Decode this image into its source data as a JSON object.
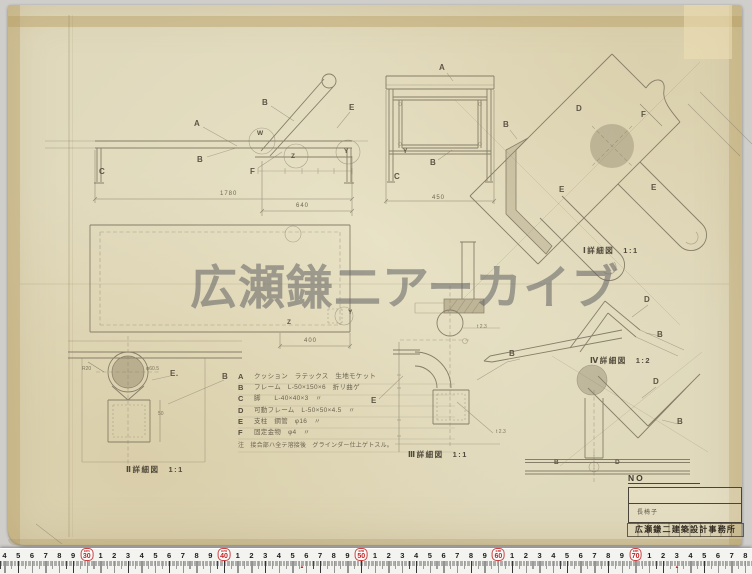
{
  "scan": {
    "watermark": "広瀬鎌二アーカイブ"
  },
  "annotations": [
    {
      "t": "A",
      "x": 194,
      "y": 119,
      "cls": "lbl"
    },
    {
      "t": "B",
      "x": 262,
      "y": 98,
      "cls": "lbl"
    },
    {
      "t": "E",
      "x": 349,
      "y": 103,
      "cls": "lbl"
    },
    {
      "t": "W",
      "x": 257,
      "y": 130,
      "cls": "sm"
    },
    {
      "t": "Z",
      "x": 291,
      "y": 153,
      "cls": "sm"
    },
    {
      "t": "Y",
      "x": 344,
      "y": 148,
      "cls": "sm"
    },
    {
      "t": "B",
      "x": 197,
      "y": 155,
      "cls": "lbl"
    },
    {
      "t": "F",
      "x": 250,
      "y": 167,
      "cls": "lbl"
    },
    {
      "t": "C",
      "x": 99,
      "y": 167,
      "cls": "lbl"
    },
    {
      "t": "1780",
      "x": 220,
      "y": 191,
      "cls": "dim"
    },
    {
      "t": "640",
      "x": 296,
      "y": 203,
      "cls": "dim"
    },
    {
      "t": "A",
      "x": 439,
      "y": 63,
      "cls": "lbl"
    },
    {
      "t": "Y",
      "x": 403,
      "y": 148,
      "cls": "sm"
    },
    {
      "t": "B",
      "x": 430,
      "y": 158,
      "cls": "lbl"
    },
    {
      "t": "C",
      "x": 394,
      "y": 172,
      "cls": "lbl"
    },
    {
      "t": "450",
      "x": 432,
      "y": 195,
      "cls": "dim"
    },
    {
      "t": "Y",
      "x": 348,
      "y": 309,
      "cls": "sm"
    },
    {
      "t": "Z",
      "x": 287,
      "y": 319,
      "cls": "sm"
    },
    {
      "t": "400",
      "x": 304,
      "y": 338,
      "cls": "dim"
    },
    {
      "t": "B",
      "x": 503,
      "y": 120,
      "cls": "lbl"
    },
    {
      "t": "D",
      "x": 576,
      "y": 104,
      "cls": "lbl"
    },
    {
      "t": "F",
      "x": 641,
      "y": 110,
      "cls": "lbl"
    },
    {
      "t": "E",
      "x": 559,
      "y": 185,
      "cls": "lbl"
    },
    {
      "t": "E",
      "x": 651,
      "y": 183,
      "cls": "lbl"
    },
    {
      "t": "Ⅰ詳細図　1:1",
      "x": 583,
      "y": 245,
      "cls": "cap"
    },
    {
      "t": "E.",
      "x": 170,
      "y": 369,
      "cls": "lbl"
    },
    {
      "t": "B",
      "x": 222,
      "y": 372,
      "cls": "lbl"
    },
    {
      "t": "Ⅱ詳細図　1:1",
      "x": 126,
      "y": 464,
      "cls": "cap"
    },
    {
      "t": "R20",
      "x": 82,
      "y": 366,
      "cls": "tiny"
    },
    {
      "t": "φ60.5",
      "x": 146,
      "y": 366,
      "cls": "tiny"
    },
    {
      "t": "50",
      "x": 158,
      "y": 411,
      "cls": "tiny"
    },
    {
      "t": "E",
      "x": 371,
      "y": 396,
      "cls": "lbl"
    },
    {
      "t": "B",
      "x": 509,
      "y": 349,
      "cls": "lbl"
    },
    {
      "t": "t 2.3",
      "x": 477,
      "y": 324,
      "cls": "tiny"
    },
    {
      "t": "t 2.3",
      "x": 496,
      "y": 429,
      "cls": "tiny"
    },
    {
      "t": "Ⅲ詳細図　1:1",
      "x": 408,
      "y": 449,
      "cls": "cap"
    },
    {
      "t": "D",
      "x": 644,
      "y": 295,
      "cls": "lbl"
    },
    {
      "t": "B",
      "x": 657,
      "y": 330,
      "cls": "lbl"
    },
    {
      "t": "Ⅳ詳細図　1:2",
      "x": 590,
      "y": 355,
      "cls": "cap"
    },
    {
      "t": "D",
      "x": 653,
      "y": 377,
      "cls": "lbl"
    },
    {
      "t": "B",
      "x": 677,
      "y": 417,
      "cls": "lbl"
    },
    {
      "t": "B",
      "x": 554,
      "y": 459,
      "cls": "sm"
    },
    {
      "t": "D",
      "x": 615,
      "y": 459,
      "cls": "sm"
    }
  ],
  "parts_list": {
    "rows": [
      {
        "key": "A",
        "desc": "クッション　ラテックス　生地モケット"
      },
      {
        "key": "B",
        "desc": "フレーム　L-50×150×6　折リ曲ゲ"
      },
      {
        "key": "C",
        "desc": "脚　　L-40×40×3　〃"
      },
      {
        "key": "D",
        "desc": "可動フレーム　L-50×50×4.5　〃"
      },
      {
        "key": "E",
        "desc": "支柱　鋼管　φ16　〃"
      },
      {
        "key": "F",
        "desc": "固定金物　φ4　〃"
      }
    ],
    "note": "注　接合部ハ全テ溶接後　グラインダー仕上ゲトスル。"
  },
  "title_block": {
    "no_label": "NO",
    "title": "長椅子",
    "stamp": "広瀬鎌二建築設計事務所"
  },
  "ruler": {
    "unit": "cm",
    "start": 24,
    "end": 78,
    "origin_x": 4.5,
    "px_per_cm": 13.72,
    "decades": [
      30,
      40,
      50,
      60,
      70
    ],
    "red_marks": [
      302,
      677
    ]
  }
}
